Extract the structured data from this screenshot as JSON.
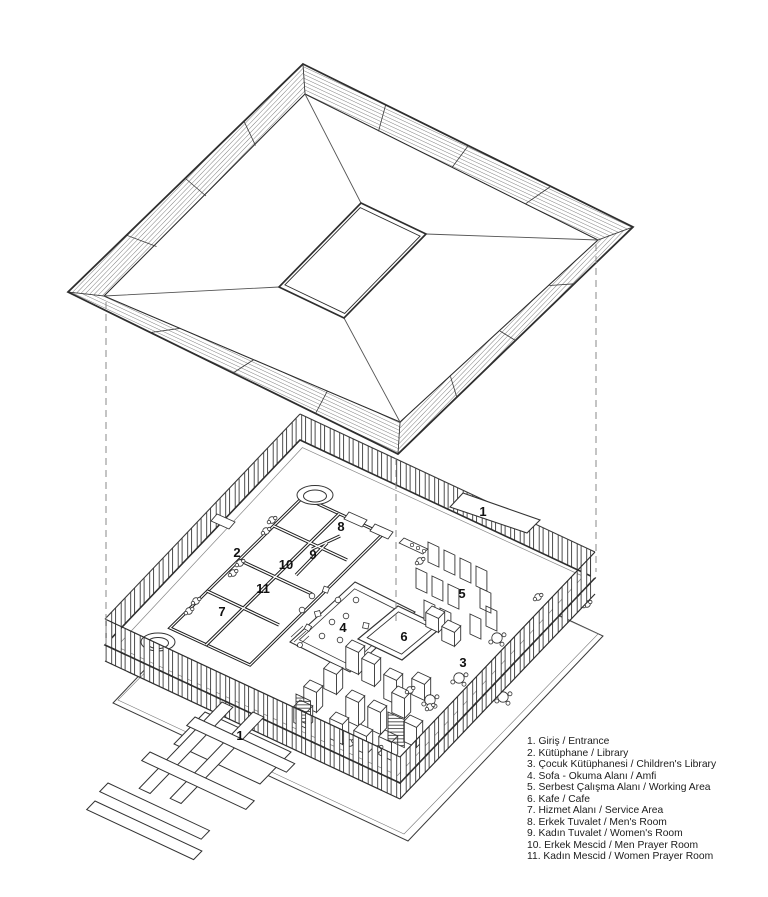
{
  "colors": {
    "background": "#ffffff",
    "line": "#333333",
    "wall": "#1f1f1f",
    "hatch": "#4a4a4a",
    "dashed_projection": "#8a8a8a",
    "text": "#111111"
  },
  "plan_labels": [
    {
      "n": "1",
      "area": "entrance-canopy",
      "x": 483,
      "y": 512
    },
    {
      "n": "2",
      "area": "library",
      "x": 237,
      "y": 553
    },
    {
      "n": "8",
      "area": "mens-room",
      "x": 341,
      "y": 527
    },
    {
      "n": "9",
      "area": "womens-room",
      "x": 313,
      "y": 555
    },
    {
      "n": "10",
      "area": "men-prayer-room",
      "x": 286,
      "y": 565
    },
    {
      "n": "11",
      "area": "women-prayer-room",
      "x": 263,
      "y": 589
    },
    {
      "n": "7",
      "area": "service-area",
      "x": 222,
      "y": 612
    },
    {
      "n": "4",
      "area": "reading-area-amfi",
      "x": 343,
      "y": 628
    },
    {
      "n": "6",
      "area": "cafe",
      "x": 404,
      "y": 637
    },
    {
      "n": "5",
      "area": "working-area",
      "x": 462,
      "y": 594
    },
    {
      "n": "3",
      "area": "childrens-library",
      "x": 463,
      "y": 663
    },
    {
      "n": "1",
      "area": "entrance-ramp",
      "x": 240,
      "y": 736
    }
  ],
  "legend": {
    "items": [
      "1. Giriş / Entrance",
      "2. Kütüphane / Library",
      "3. Çocuk Kütüphanesi / Children's Library",
      "4. Sofa - Okuma Alanı / Amfi",
      "5. Serbest Çalışma Alanı / Working Area",
      "6. Kafe / Cafe",
      "7. Hizmet Alanı / Service Area",
      "8. Erkek Tuvalet / Men's Room",
      "9. Kadın Tuvalet / Women's Room",
      "10. Erkek Mescid / Men Prayer Room",
      "11. Kadın Mescid / Women Prayer Room"
    ]
  }
}
